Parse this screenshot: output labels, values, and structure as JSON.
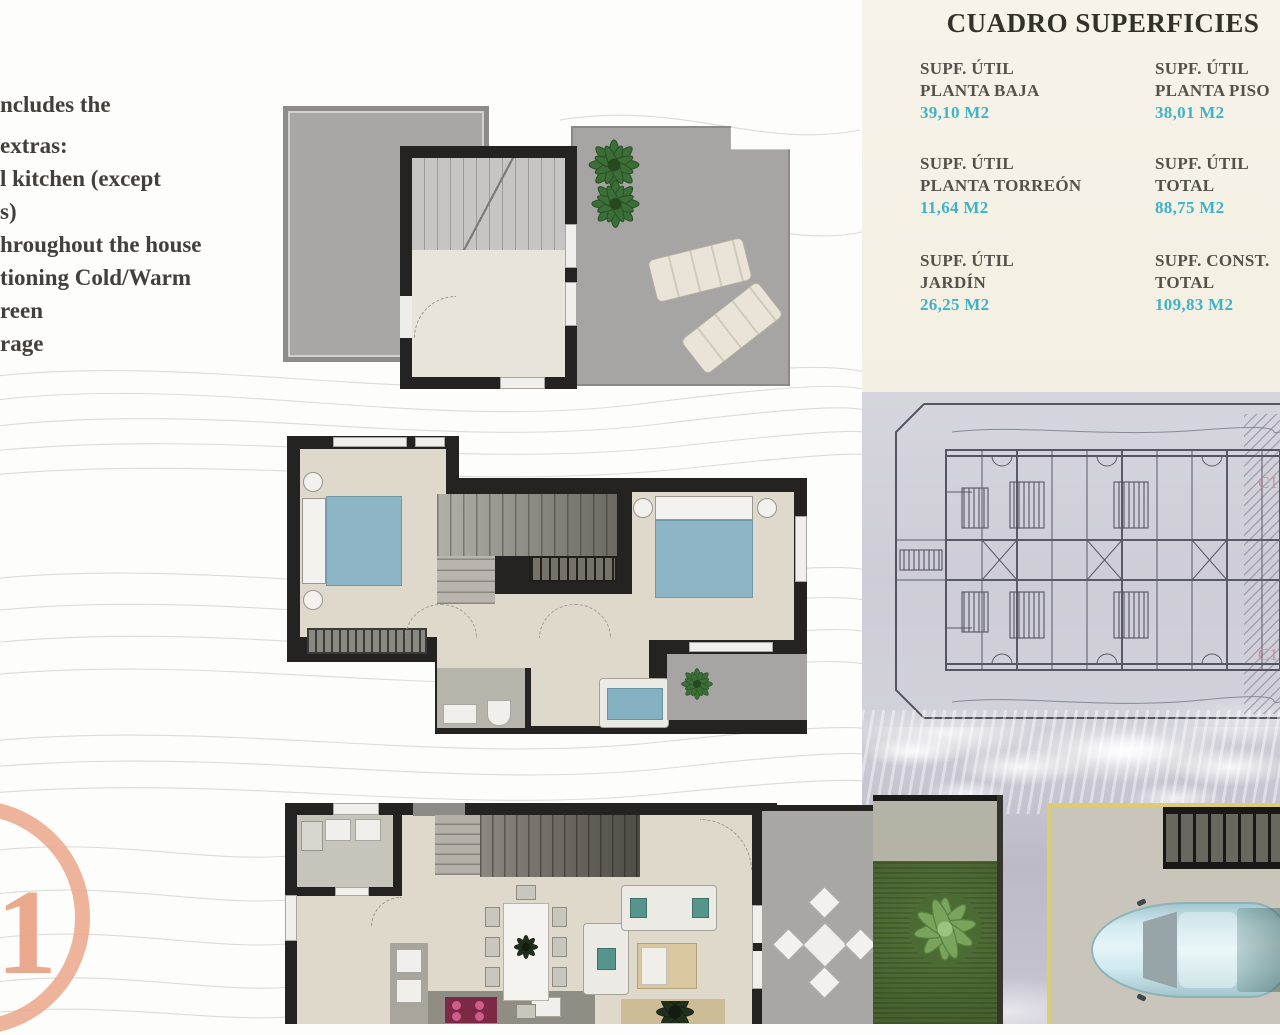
{
  "notes": {
    "lines": [
      "ncludes the",
      "extras:",
      "l kitchen (except",
      "s)",
      "hroughout the house",
      "tioning Cold/Warm",
      "reen",
      "rage"
    ]
  },
  "logo": {
    "number": "1",
    "color": "#ecab90"
  },
  "surfaces_table": {
    "title": "CUADRO SUPERFICIES",
    "bg_color": "#f6f2e7",
    "label_color": "#54514b",
    "value_color": "#3fb3c5",
    "entries": [
      {
        "label1": "SUPF. ÚTIL",
        "label2": "PLANTA BAJA",
        "value": "39,10 M2"
      },
      {
        "label1": "SUPF. ÚTIL",
        "label2": "PLANTA PISO",
        "value": "38,01 M2"
      },
      {
        "label1": "SUPF. ÚTIL",
        "label2": "PLANTA TORREÓN",
        "value": "11,64 M2"
      },
      {
        "label1": "SUPF. ÚTIL",
        "label2": "TOTAL",
        "value": "88,75 M2"
      },
      {
        "label1": "SUPF. ÚTIL",
        "label2": "JARDÍN",
        "value": "26,25 M2"
      },
      {
        "label1": "SUPF. CONST.",
        "label2": "TOTAL",
        "value": "109,83 M2"
      }
    ]
  },
  "site_plan": {
    "labels": [
      "C1",
      "C1"
    ],
    "label_color": "#c9919c"
  },
  "colors": {
    "accent_cyan": "#3fb3c5",
    "cream_panel": "#f6f2e7",
    "logo_salmon": "#ecab90",
    "plan_wall": "#242322",
    "plan_floor": "#ded9cb",
    "bed_blue": "#8db5c6",
    "grass_green": "#4e6b34",
    "car_blue": "#d4ebf1",
    "parking_line_yellow": "#dccc72",
    "cooktop_magenta": "#7c2947",
    "sea": "#c5c3ce"
  }
}
